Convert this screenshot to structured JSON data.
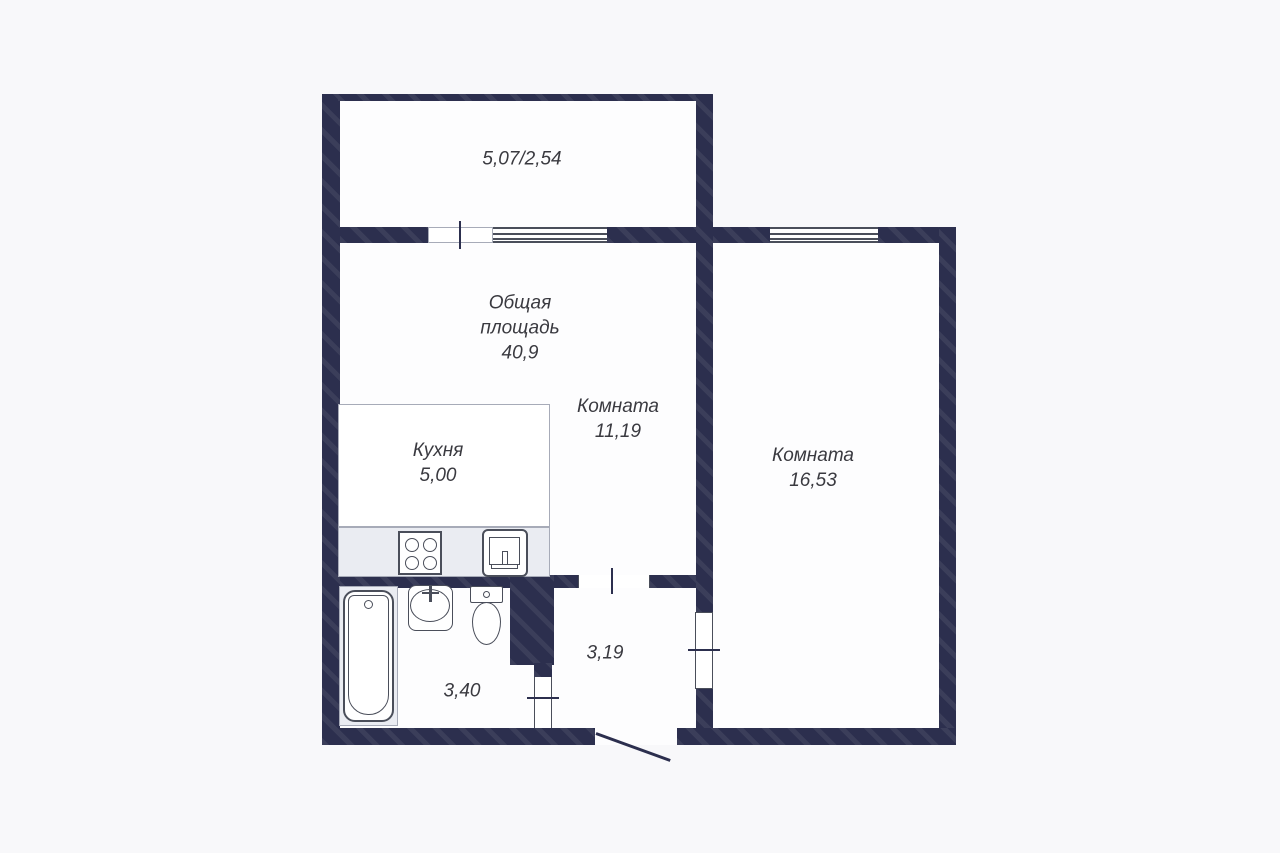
{
  "title": "Apartment floor plan",
  "colors": {
    "wall": "#2c2f4e",
    "bg": "#f8f8fa",
    "room": "#fdfdfe",
    "counter": "#eaecf2",
    "outline": "#4a4e5a",
    "text": "#3a3a40"
  },
  "labels": {
    "balcony_dims": "5,07/2,54",
    "total_line1": "Общая",
    "total_line2": "площадь",
    "total_value": "40,9",
    "room1_name": "Комната",
    "room1_area": "11,19",
    "kitchen_name": "Кухня",
    "kitchen_area": "5,00",
    "room2_name": "Комната",
    "room2_area": "16,53",
    "hallway_area": "3,19",
    "bathroom_area": "3,40"
  },
  "fixtures": {
    "stove": "stove-icon",
    "kitchen_sink": "kitchen-sink-icon",
    "bathtub": "bathtub-icon",
    "washbasin": "washbasin-icon",
    "toilet": "toilet-icon"
  }
}
